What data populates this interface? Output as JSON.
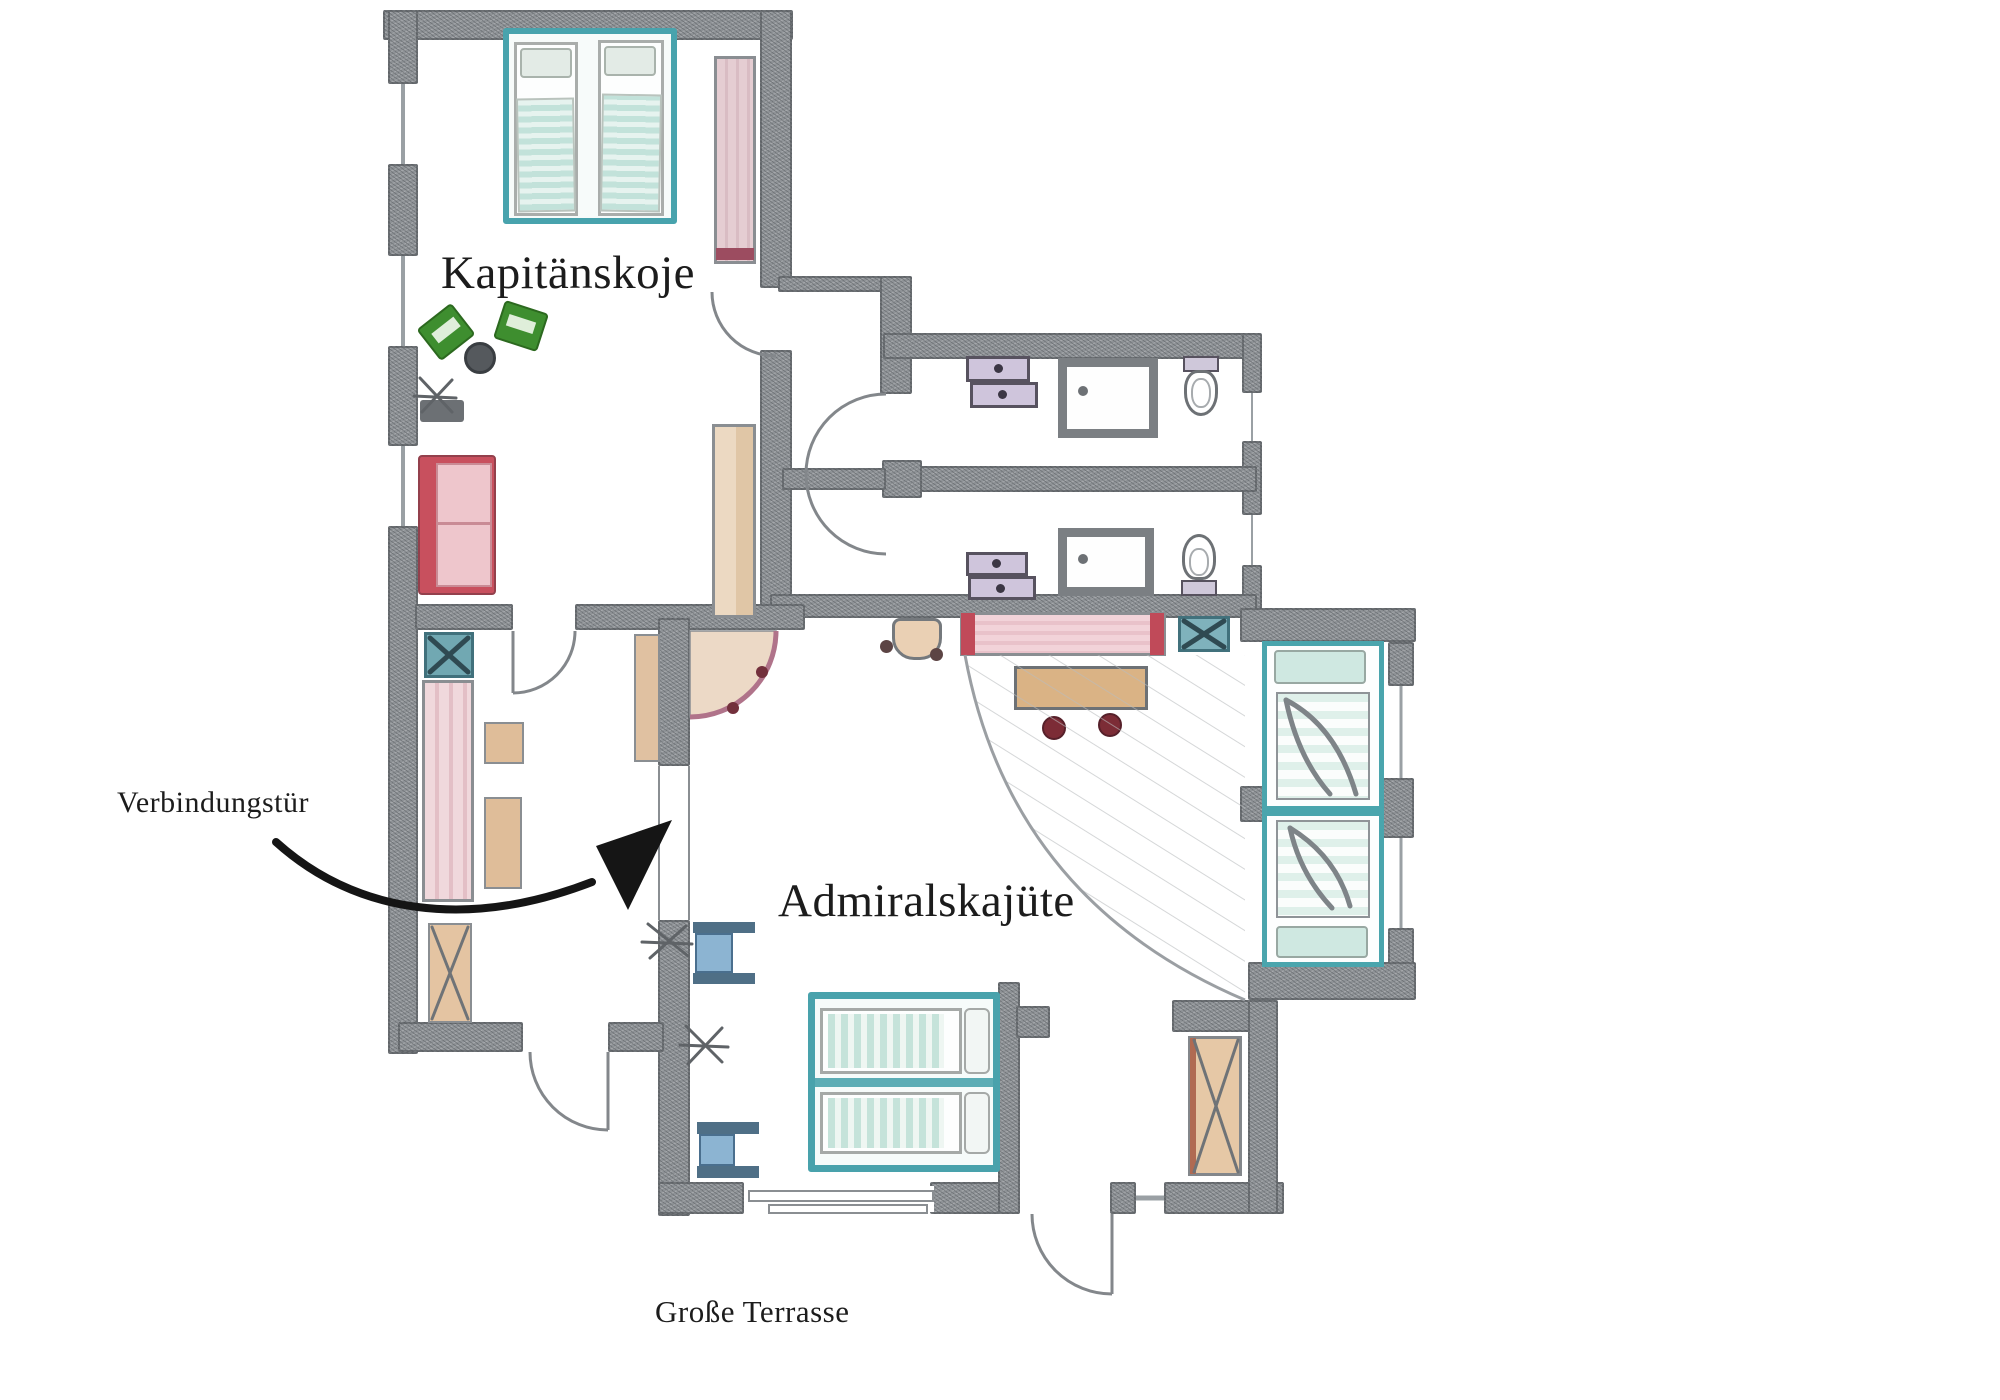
{
  "labels": {
    "room_top": "Kapitänskoje",
    "room_main": "Admiralskajüte",
    "annotation_connecting_door": "Verbindungstür",
    "terrace": "Große Terrasse"
  },
  "colors": {
    "wall_graphite": "#8f9397",
    "bed_frame_teal": "#49a2ac",
    "blanket_teal": "#c5e3da",
    "sofa_red": "#c8505e",
    "sideboard_red": "#c04a59",
    "wardrobe_pink": "#eed5d9",
    "wood_tan": "#dfbd99",
    "chair_green": "#3e8e2f",
    "drawer_purple": "#cfc5dc",
    "nightstand_blue": "#8cb4d2",
    "stool_maroon": "#7c2c36",
    "corner_arc_mauve": "#b0738a",
    "annotation_ink": "#151515"
  },
  "rooms": [
    {
      "name": "Kapitänskoje",
      "furniture": [
        "double-bed",
        "wardrobe",
        "green-armchairs",
        "round-side-table",
        "wall-lamp",
        "sofa",
        "tall-wardrobe"
      ]
    },
    {
      "name": "Admiralskajüte",
      "furniture": [
        "double-bed",
        "single-bed",
        "single-bed",
        "nightstand",
        "nightstand",
        "sideboard",
        "dining-table",
        "stool",
        "stool",
        "built-in-wardrobe",
        "washbasin",
        "corner-unit",
        "wall-lamp"
      ]
    },
    {
      "name": "Bäder",
      "furniture": [
        "vanity-drawers",
        "shower",
        "toilet",
        "vanity-drawers",
        "shower",
        "toilet"
      ]
    }
  ]
}
